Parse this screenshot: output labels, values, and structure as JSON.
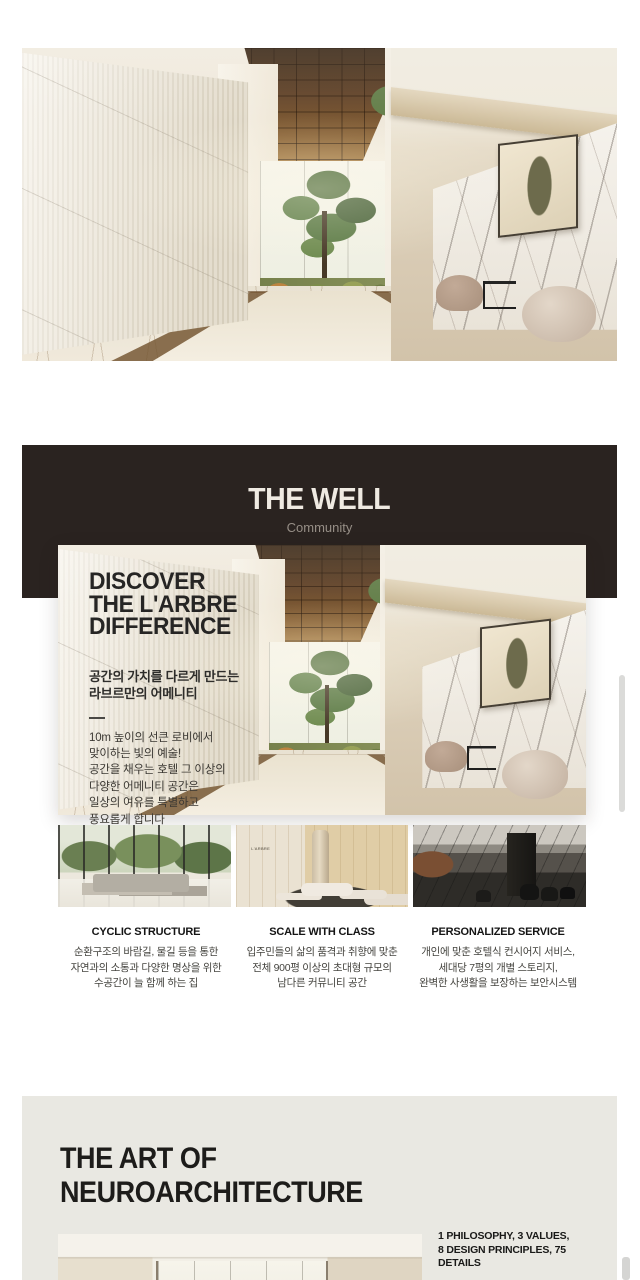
{
  "colors": {
    "page_bg": "#FFFFFF",
    "banner_bg": "#2A2320",
    "banner_title": "#EFEAE2",
    "banner_subtitle": "#968E86",
    "neuro_bg": "#E9E8E2",
    "heading_dark": "#1D1C1A"
  },
  "well_section": {
    "title": "THE WELL",
    "subtitle": "Community",
    "card": {
      "heading_lines": [
        "DISCOVER",
        "THE L'ARBRE",
        "DIFFERENCE"
      ],
      "subheading_lines": [
        "공간의 가치를 다르게 만드는",
        "라브르만의 어메니티"
      ],
      "body_lines": [
        "10m 높이의 선큰 로비에서",
        "맞이하는 빛의 예술!",
        "공간을 채우는 호텔 그 이상의",
        "다양한 어메니티 공간은",
        "일상의 여유를 특별하고",
        "풍요롭게 합니다"
      ]
    },
    "thumb_sign": "L'ARBRE",
    "features": [
      {
        "title": "CYCLIC STRUCTURE",
        "lines": [
          "순환구조의 바람길, 물길 등을 통한",
          "자연과의 소통과 다양한 명상을 위한",
          "수공간이 늘 함께 하는 집"
        ]
      },
      {
        "title": "SCALE WITH CLASS",
        "lines": [
          "입주민들의 삶의 품격과 취향에 맞춘",
          "전체 900평 이상의 초대형 규모의",
          "남다른 커뮤니티 공간"
        ]
      },
      {
        "title": "PERSONALIZED SERVICE",
        "lines": [
          "개인에 맞춘 호텔식 컨시어지 서비스,",
          "세대당 7평의 개별 스토리지,",
          "완벽한 사생활을 보장하는 보안시스템"
        ]
      }
    ]
  },
  "neuro_section": {
    "title_lines": [
      "THE ART OF",
      "NEUROARCHITECTURE"
    ],
    "stat_lines": [
      "1 PHILOSOPHY, 3 VALUES,",
      "8 DESIGN PRINCIPLES, 75 DETAILS"
    ],
    "body_lines": [
      "철학, 가치, 원칙과 가이드를 통해 만들어 낸",
      "75가지 디테일을 적용하여 완성된 공간의"
    ]
  }
}
